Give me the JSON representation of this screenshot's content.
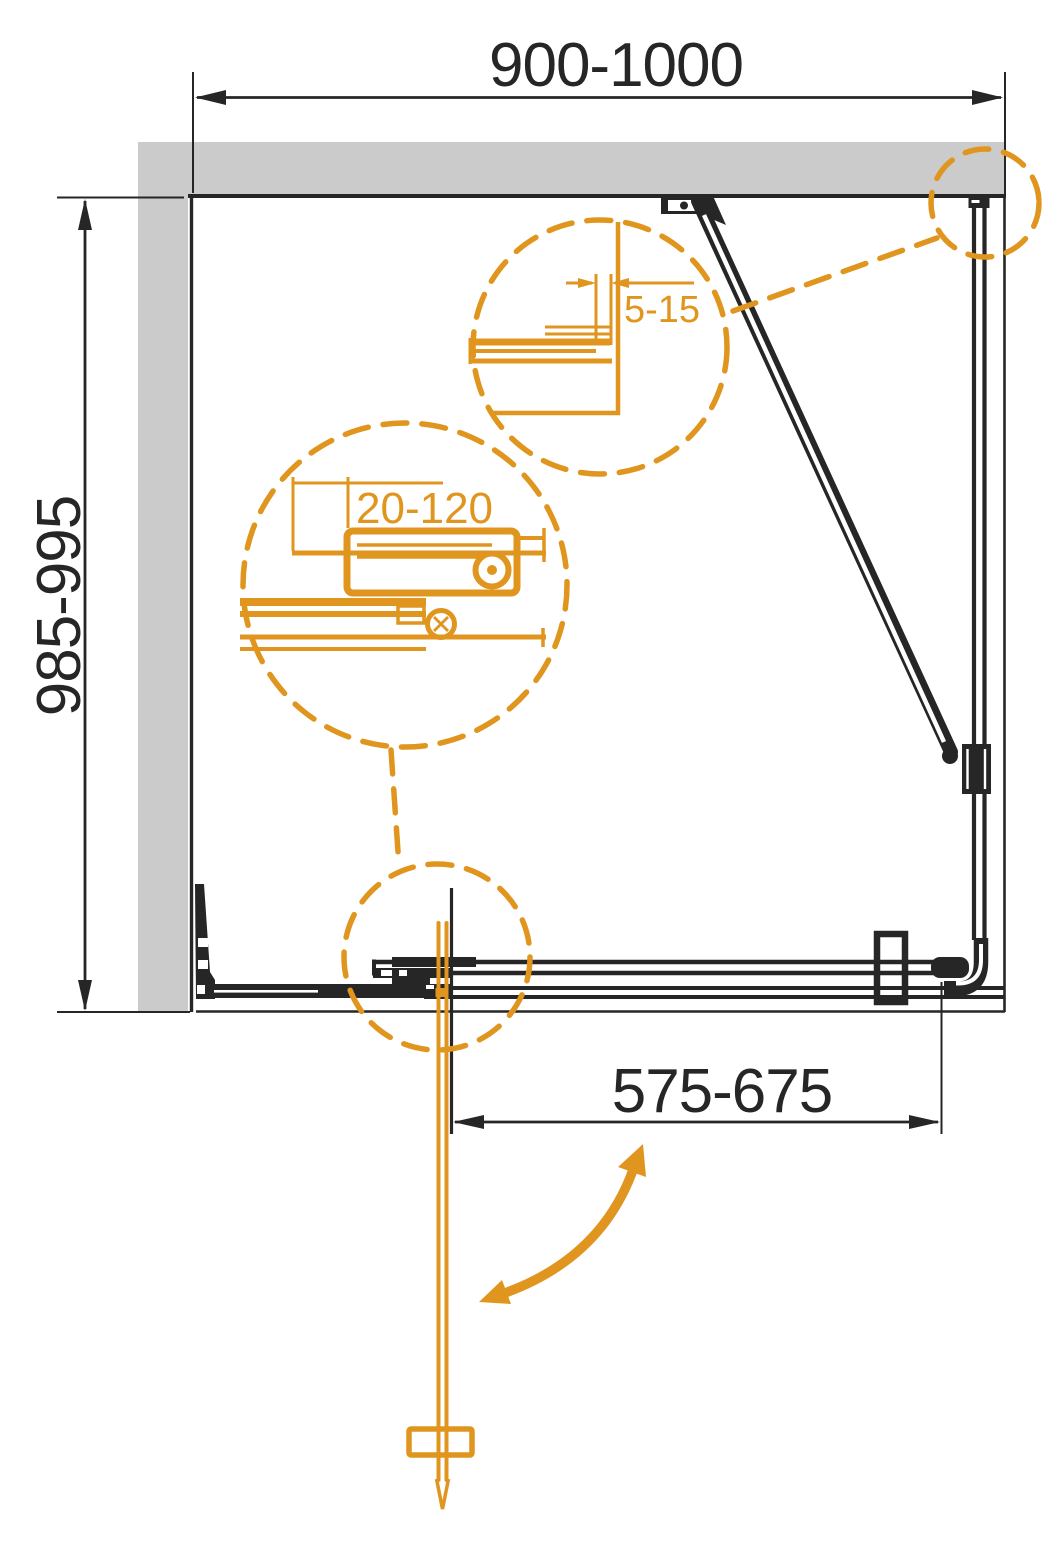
{
  "diagram": {
    "type": "technical-drawing",
    "subject": "Shower enclosure plan view with pivot door, fixed side panel and adjustment ranges",
    "colors": {
      "wall_gray": "#CBCBCB",
      "line_black": "#262626",
      "accent_orange": "#E0961E"
    },
    "dims": {
      "top_width": "900-1000",
      "side_depth": "985-995",
      "door_width": "575-675",
      "wall_profile_adjust": "5-15",
      "bracket_adjust": "20-120"
    }
  }
}
